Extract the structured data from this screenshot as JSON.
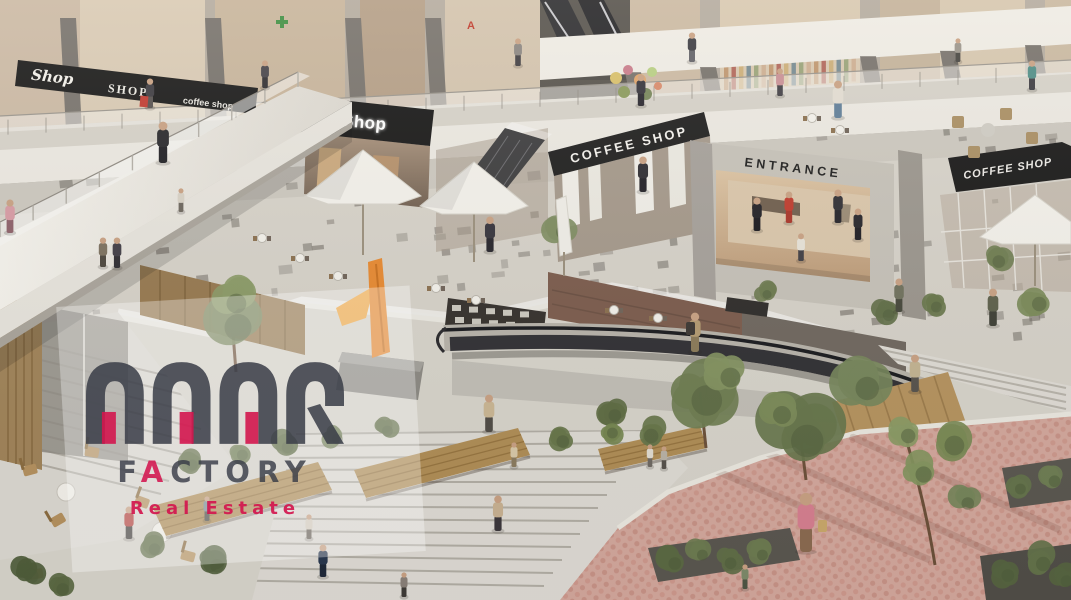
{
  "signs": {
    "upper_left": {
      "script": "Shop",
      "serif": "SHOP",
      "coffee": "coffee shop"
    },
    "shop_awning": "Shop",
    "coffee_shop_main": "COFFEE SHOP",
    "entrance": "ENTRANCE",
    "coffee_shop_right": "COFFEE SHOP",
    "storefront_letter": "A"
  },
  "watermark": {
    "brand": "AQAR",
    "factory_segments": [
      "F",
      "A",
      "CTORY"
    ],
    "tagline": "Real Estate",
    "accent_color": "#d3164e",
    "text_color": "#3a3e49"
  }
}
